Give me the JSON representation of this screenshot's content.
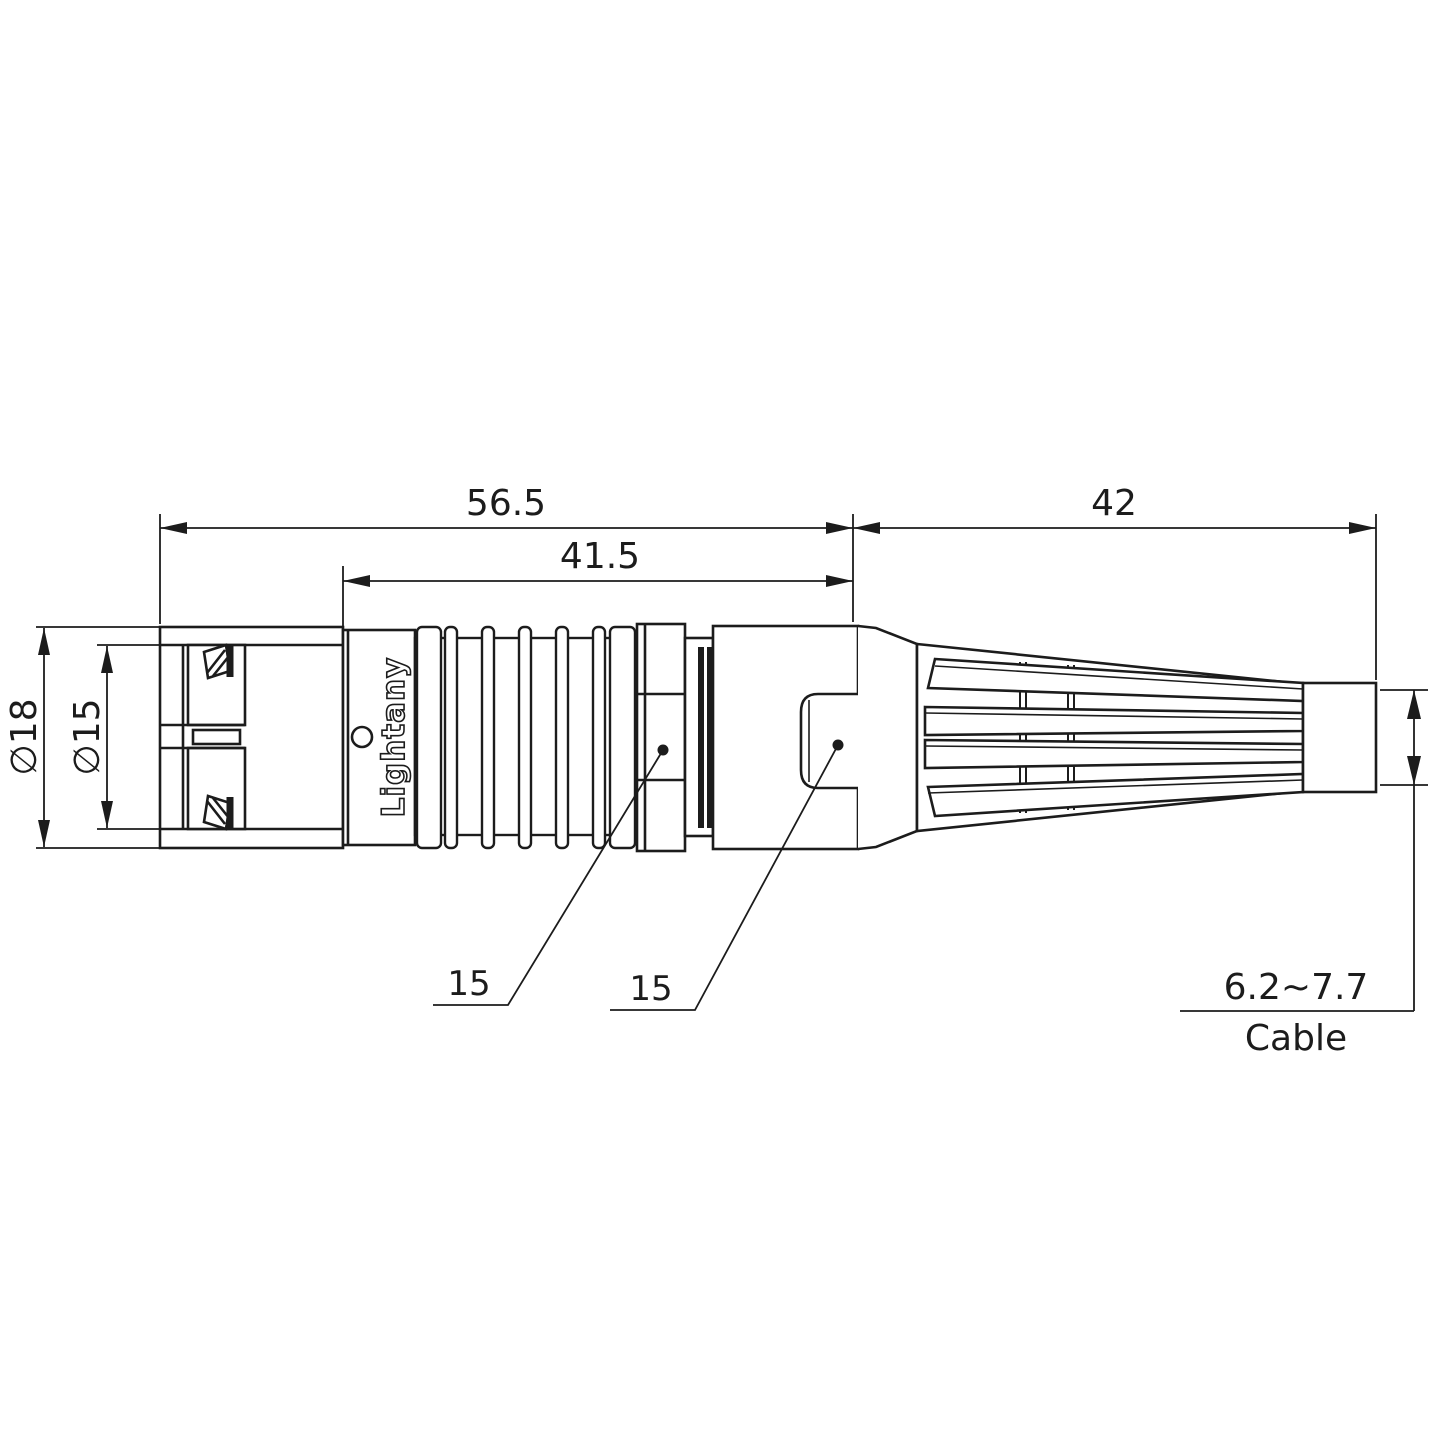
{
  "colors": {
    "line": "#1c1c1c",
    "background": "#ffffff",
    "watermark": "#f3b9b9"
  },
  "watermark": {
    "text": "Lightany"
  },
  "part": {
    "engraving": "Lightany"
  },
  "dimensions": {
    "total_length": "56.5",
    "front_length": "41.5",
    "boot_length": "42",
    "outer_diameter": "∅18",
    "inner_diameter": "∅15",
    "nut_callout": "15",
    "body_callout": "15",
    "cable_range": "6.2~7.7",
    "cable_label": "Cable"
  }
}
